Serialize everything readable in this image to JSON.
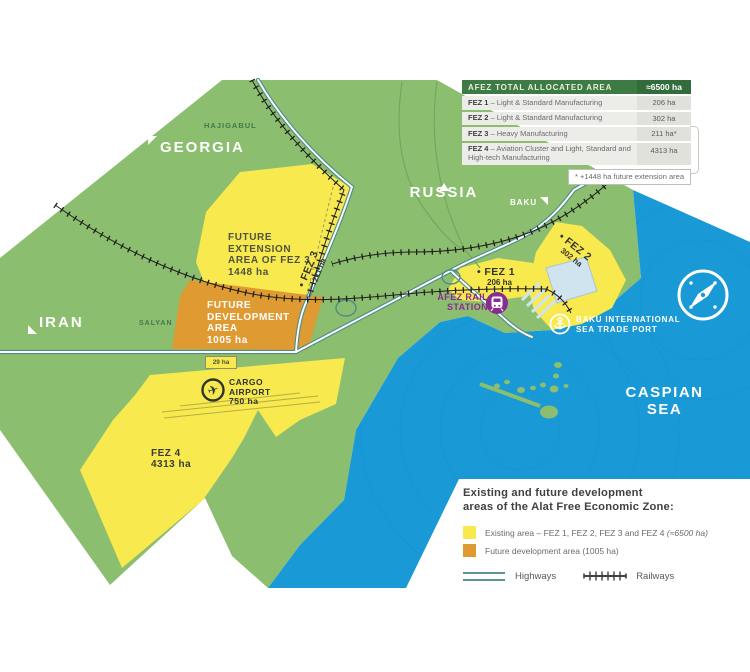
{
  "colors": {
    "land": "#8CBE6F",
    "sea": "#1999D6",
    "existing_zone": "#F7E94E",
    "future_zone": "#DF9B32",
    "highway": "#4F8C8A",
    "railway": "#1F1F1C",
    "table_header": "#3E7B44",
    "station": "#8A2C8F"
  },
  "map": {
    "countries": {
      "georgia": "GEORGIA",
      "russia": "RUSSIA",
      "iran": "IRAN"
    },
    "cities": {
      "baku": "BAKU",
      "hajigabul": "HAJIGABUL",
      "salyan": "SALYAN"
    },
    "sea": {
      "line1": "CASPIAN",
      "line2": "SEA"
    },
    "zones": {
      "future_extension": {
        "line1": "FUTURE",
        "line2": "EXTENSION",
        "line3": "AREA OF FEZ 3",
        "line4": "1448 ha"
      },
      "future_development": {
        "line1": "FUTURE",
        "line2": "DEVELOPMENT",
        "line3": "AREA",
        "line4": "1005 ha"
      },
      "fez1": {
        "name": "• FEZ 1",
        "area": "206 ha"
      },
      "fez2": {
        "name": "• FEZ 2",
        "area": "302 ha"
      },
      "fez3": {
        "name": "• FEZ 3",
        "area": "211 ha"
      },
      "fez4": {
        "name": "FEZ 4",
        "area": "4313 ha"
      },
      "cargo_airport": {
        "line1": "CARGO",
        "line2": "AIRPORT",
        "area": "750 ha"
      },
      "small_parcel": "29 ha"
    },
    "pois": {
      "rail_station": {
        "line1": "AFEZ RAIL",
        "line2": "STATION"
      },
      "sea_port": {
        "line1": "BAKU INTERNATIONAL",
        "line2": "SEA TRADE PORT"
      }
    },
    "icons": {
      "airplane": "✈"
    }
  },
  "table": {
    "header": {
      "label": "AFEZ TOTAL ALLOCATED AREA",
      "value": "≈6500 ha"
    },
    "rows": [
      {
        "zone": "FEZ 1",
        "desc": "– Light & Standard Manufacturing",
        "value": "206 ha"
      },
      {
        "zone": "FEZ 2",
        "desc": "– Light & Standard Manufacturing",
        "value": "302 ha"
      },
      {
        "zone": "FEZ 3",
        "desc": "– Heavy Manufacturing",
        "value": "211 ha*"
      },
      {
        "zone": "FEZ 4",
        "desc": "– Aviation Cluster and Light, Standard and High-tech Manufacturing",
        "value": "4313 ha"
      }
    ],
    "footnote": "* +1448 ha future extension area"
  },
  "legend": {
    "title_line1": "Existing and future development",
    "title_line2": "areas of the Alat Free Economic Zone:",
    "items": [
      {
        "label": "Existing area – FEZ 1, FEZ 2, FEZ 3 and FEZ 4 ",
        "note": "(≈6500 ha)"
      },
      {
        "label": "Future development area (1005 ha)",
        "note": ""
      }
    ],
    "lines": [
      {
        "label": "Highways"
      },
      {
        "label": "Railways"
      }
    ]
  }
}
